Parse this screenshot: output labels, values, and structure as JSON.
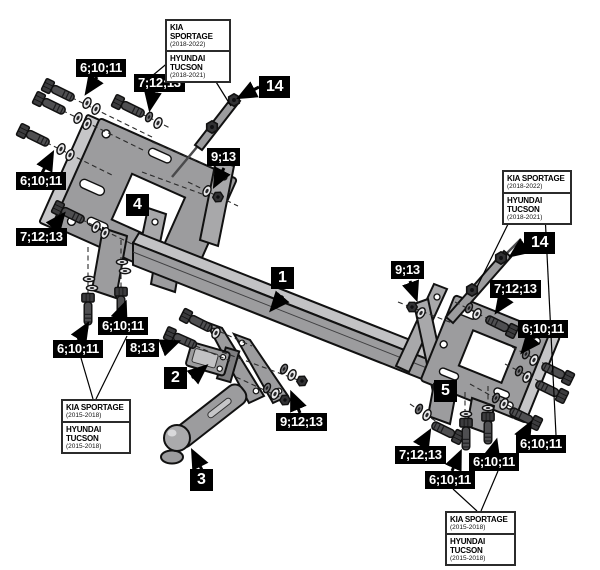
{
  "callouts": [
    {
      "name": "fasteners-top-left",
      "text": "6;10;11"
    },
    {
      "name": "fasteners-top",
      "text": "7;12;13"
    },
    {
      "name": "stabilizer-rod-left",
      "text": "14"
    },
    {
      "name": "fasteners-left",
      "text": "6;10;11"
    },
    {
      "name": "left-bracket",
      "text": "4"
    },
    {
      "name": "fasteners-left-mid",
      "text": "7;12;13"
    },
    {
      "name": "nut-center",
      "text": "9;13"
    },
    {
      "name": "crossbar",
      "text": "1"
    },
    {
      "name": "fasteners-center-upper",
      "text": "6;10;11"
    },
    {
      "name": "fasteners-center-lower",
      "text": "6;10;11"
    },
    {
      "name": "bolt-ballmount",
      "text": "8;13"
    },
    {
      "name": "ballmount-bracket",
      "text": "2"
    },
    {
      "name": "fasteners-fork",
      "text": "9;12;13"
    },
    {
      "name": "towball-arm",
      "text": "3"
    },
    {
      "name": "nut-right",
      "text": "9;13"
    },
    {
      "name": "stabilizer-rod-right",
      "text": "14"
    },
    {
      "name": "fasteners-right-upper",
      "text": "7;12;13"
    },
    {
      "name": "fasteners-right",
      "text": "6;10;11"
    },
    {
      "name": "right-bracket",
      "text": "5"
    },
    {
      "name": "fasteners-bottom-right",
      "text": "7;12;13"
    },
    {
      "name": "fasteners-br-right",
      "text": "6;10;11"
    },
    {
      "name": "fasteners-br-mid",
      "text": "6;10;11"
    },
    {
      "name": "fasteners-br-left",
      "text": "6;10;11"
    }
  ],
  "vehicle_boxes": [
    {
      "name": "top",
      "rows": [
        {
          "model": "KIA SPORTAGE",
          "years": "(2018-2022)"
        },
        {
          "model": "HYUNDAI TUCSON",
          "years": "(2018-2021)"
        }
      ]
    },
    {
      "name": "right",
      "rows": [
        {
          "model": "KIA SPORTAGE",
          "years": "(2018-2022)"
        },
        {
          "model": "HYUNDAI TUCSON",
          "years": "(2018-2021)"
        }
      ]
    },
    {
      "name": "bottom-left",
      "rows": [
        {
          "model": "KIA SPORTAGE",
          "years": "(2015-2018)"
        },
        {
          "model": "HYUNDAI TUCSON",
          "years": "(2015-2018)"
        }
      ]
    },
    {
      "name": "bottom-right",
      "rows": [
        {
          "model": "KIA SPORTAGE",
          "years": "(2015-2018)"
        },
        {
          "model": "HYUNDAI TUCSON",
          "years": "(2015-2018)"
        }
      ]
    }
  ],
  "colors": {
    "part_fill": "#9c9c9e",
    "part_light": "#c6c6c8",
    "label_bg": "#000000",
    "label_text": "#ffffff",
    "outline": "#111111"
  }
}
